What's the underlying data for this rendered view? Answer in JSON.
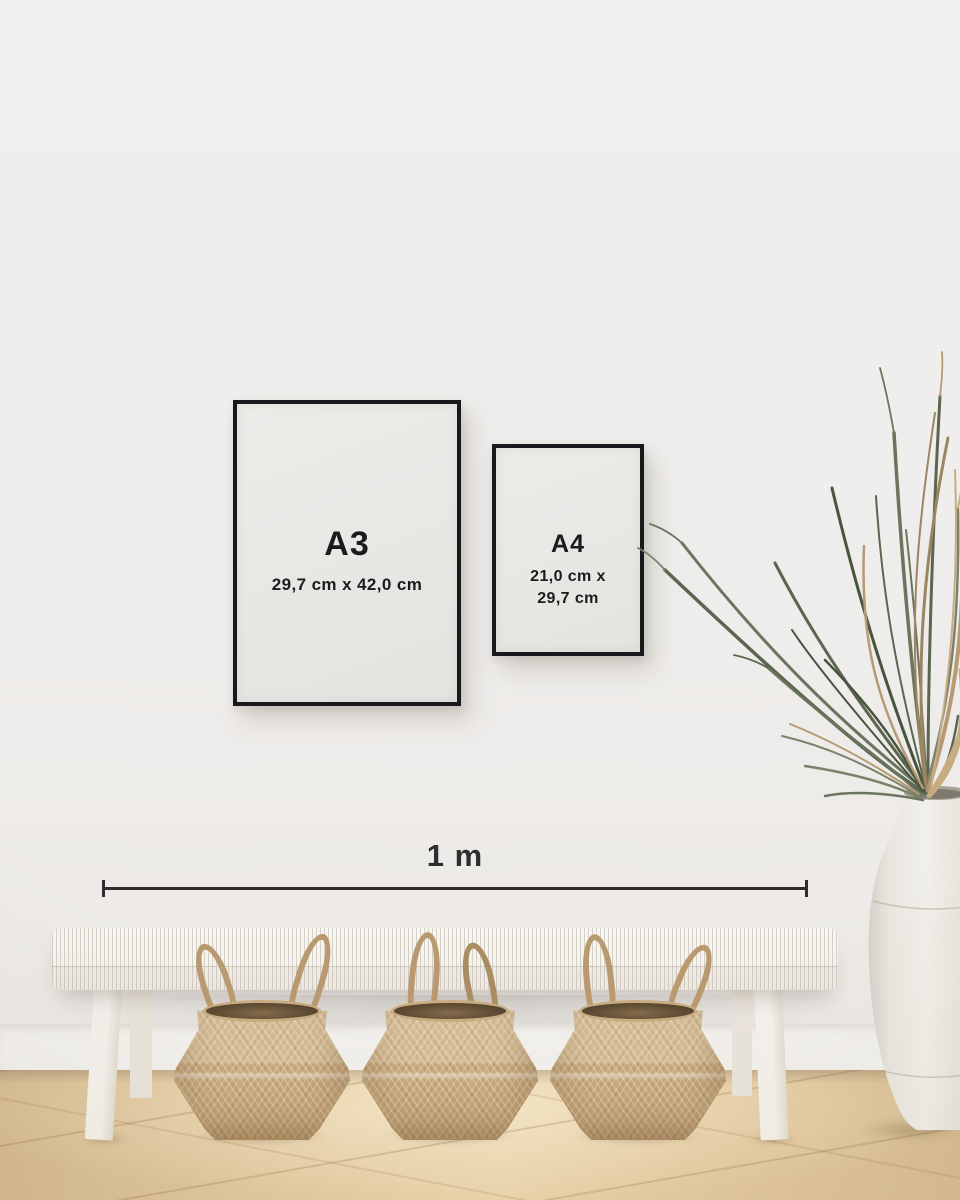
{
  "frames": {
    "a3": {
      "label": "A3",
      "dimensions": "29,7 cm x 42,0 cm"
    },
    "a4": {
      "label": "A4",
      "dimensions_line1": "21,0 cm x",
      "dimensions_line2": "29,7 cm"
    }
  },
  "ruler": {
    "label": "1 m"
  },
  "scene": {
    "objects": [
      "black framed A3 size print",
      "black framed A4 size print",
      "1 m scale bar",
      "white woven bench",
      "three seagrass belly baskets",
      "dried palm plant",
      "white ceramic floor vase",
      "oak wood floor"
    ]
  },
  "colors": {
    "wall": "#efedeb",
    "frame_border": "#17191d",
    "paper": "#eae8e5",
    "text": "#1b1b1e",
    "ruler": "#2e2e30",
    "bench": "#f6f3ee",
    "basket": "#c9ac82",
    "basket_interior": "#5e4b33",
    "floor": "#e4c99e",
    "plant_green": "#5a6650",
    "plant_dried": "#b59a73",
    "vase": "#ebe8e2"
  }
}
